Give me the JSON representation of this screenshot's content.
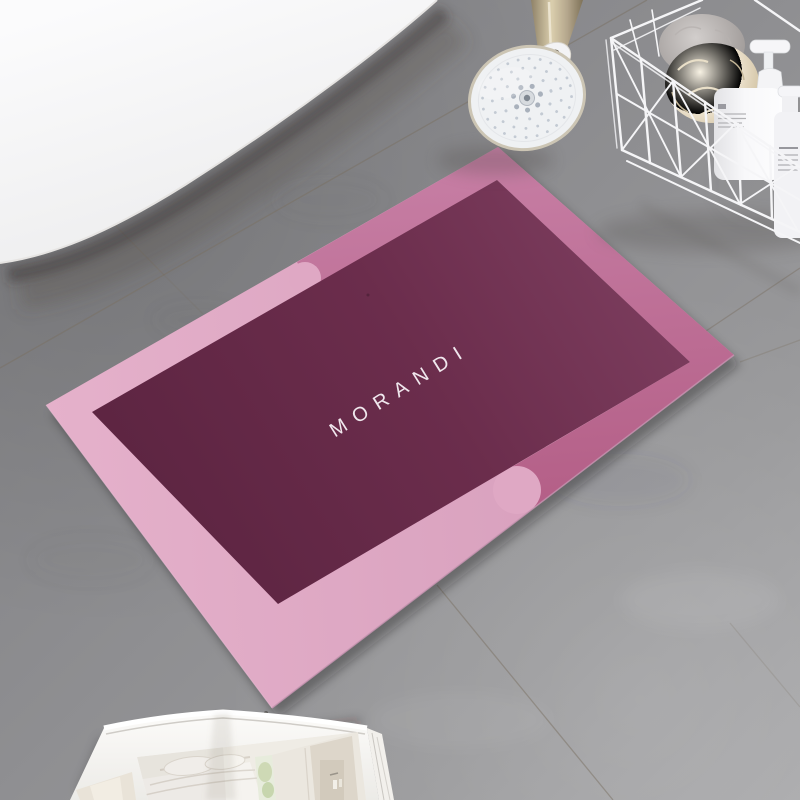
{
  "scene": {
    "setting": "bathroom floor scene, top-down angled view",
    "objects": [
      "bathtub",
      "shower-head",
      "wire-storage-basket",
      "loofahs",
      "pump-bottles",
      "two-tone-bath-mat",
      "open-magazine",
      "concrete-tile-floor"
    ]
  },
  "mat": {
    "brand_text": "MORANDI",
    "style": "color-block rectangular bath mat, rotated diagonally",
    "colors": {
      "center": "#6b2d4c",
      "center_light": "#7c3d5e",
      "border_light": "#dfa8c4",
      "border_rose": "#bf6d97",
      "text": "#f6eff4"
    }
  },
  "environment": {
    "floor_color": "#8e8e90",
    "floor_light_color": "#a6a6a8",
    "grout_color": "#7a6f61",
    "bathtub_color": "#f8f8f9"
  },
  "shower": {
    "face_color": "#eff1f3",
    "rim_color": "#ccc5b4",
    "handle_color": "#bfae92",
    "nozzle_color": "#c3cad3"
  },
  "basket": {
    "wire_color": "#f5f5f7",
    "bottle_color": "#f7f7f9",
    "loofah_cream_color": "#efe6d1",
    "loofah_gray_color": "#b5b0ae"
  },
  "book": {
    "page_color": "#f5f3f0",
    "photo_theme": "pale bedroom interior photos"
  }
}
